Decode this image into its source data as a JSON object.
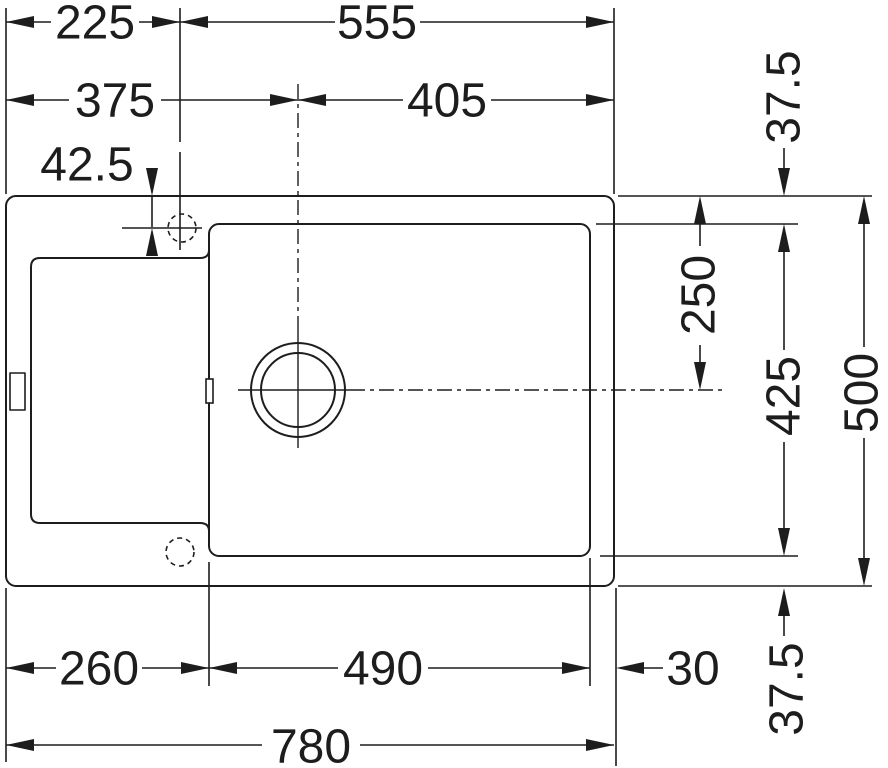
{
  "colors": {
    "line": "#1d1d1d",
    "background": "#ffffff"
  },
  "dimensions": {
    "top": {
      "faucet_from_left": "225",
      "faucet_to_right": "555",
      "drain_from_left": "375",
      "drain_to_right": "405",
      "faucet_from_edge": "42.5"
    },
    "right": {
      "rim_top": "37.5",
      "drain_from_top": "250",
      "bowl_depth": "425",
      "overall_depth": "500",
      "rim_bottom": "37.5"
    },
    "bottom": {
      "left_section": "260",
      "bowl_width": "490",
      "rim_right": "30",
      "overall_width": "780"
    }
  }
}
